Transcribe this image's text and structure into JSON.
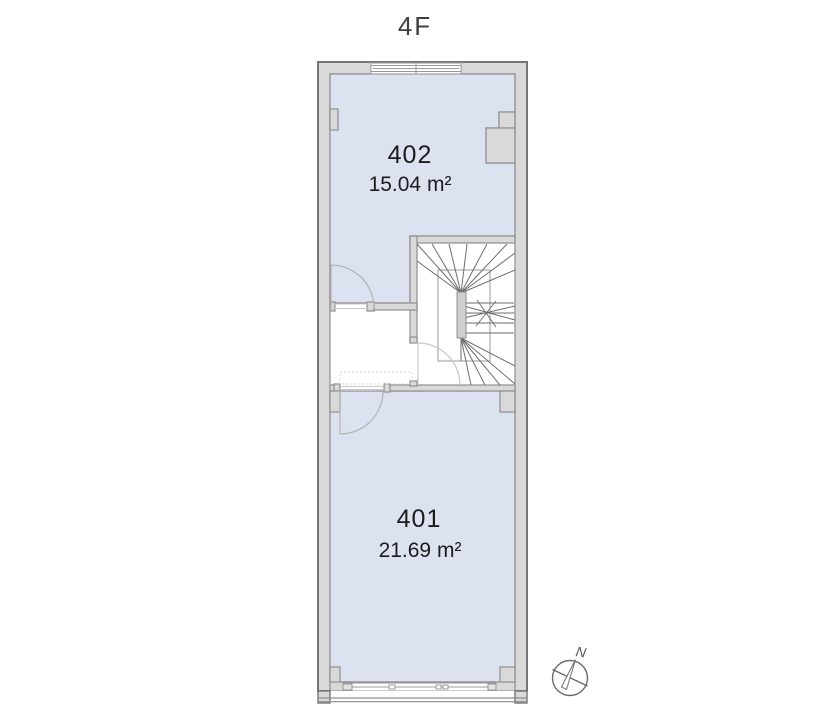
{
  "title": "4F",
  "rooms": [
    {
      "number": "402",
      "area": "15.04 m²"
    },
    {
      "number": "401",
      "area": "21.69 m²"
    }
  ],
  "compass": {
    "north_label": "N"
  },
  "colors": {
    "floor_fill": "#dce2f0",
    "wall_fill": "#d9d9d9",
    "wall_stroke": "#8e8e8e",
    "outer_stroke": "#767676",
    "stair_stroke": "#6e6e6e",
    "door_stroke": "#b3b3b3"
  }
}
